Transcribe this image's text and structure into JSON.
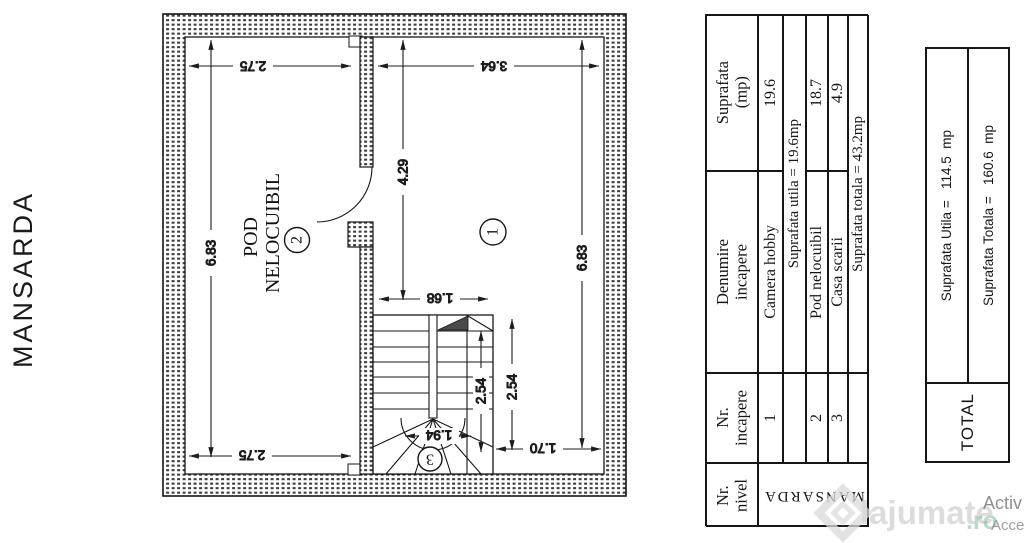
{
  "page": {
    "left_label": "MANSARDA"
  },
  "floorplan": {
    "room2_label_line1": "POD",
    "room2_label_line2": "NELOCUIBIL",
    "room_numbers": {
      "r1": "1",
      "r2": "2",
      "r3": "3"
    },
    "dims": {
      "top_left": "2.75",
      "top_right": "3.64",
      "hall_height": "4.29",
      "left_height": "6.83",
      "right_height": "6.83",
      "stair_width": "1.68",
      "stair_depth_inner": "2.54",
      "stair_depth_outer": "2.54",
      "stair_arc": "1.94",
      "bottom_right": "1.70",
      "bottom_left": "2.75"
    }
  },
  "room_table": {
    "header_nivel": "Nr.\nnivel",
    "header_incapere": "Nr.\nincapere",
    "header_denumire": "Denumire\nincapere",
    "header_suprafata": "Suprafata\n(mp)",
    "level_name": "MANSARDA",
    "rows": [
      {
        "nr": "1",
        "name": "Camera hobby",
        "area": "19.6"
      },
      {
        "summary": "Suprafata utila = 19.6mp"
      },
      {
        "nr": "2",
        "name": "Pod nelocuibil",
        "area": "18.7"
      },
      {
        "nr": "3",
        "name": "Casa scarii",
        "area": "4.9"
      },
      {
        "summary": "Suprafata totala = 43.2mp"
      }
    ]
  },
  "total_table": {
    "title": "TOTAL",
    "row_utila": "Suprafata Utila =   114.5  mp",
    "row_totala": "Suprafata Totala =   160.6  mp"
  },
  "watermark": {
    "brand": "lajumate",
    "suffix": ".ro",
    "corner_line1": "Activ",
    "corner_line2": "Accesa"
  }
}
